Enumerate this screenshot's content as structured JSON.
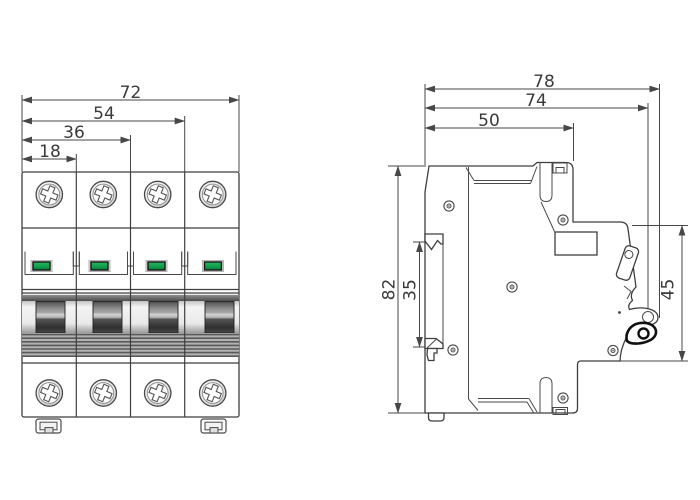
{
  "drawing": {
    "front_view": {
      "pole_count": 4,
      "dimensions": {
        "overall_width": "72",
        "width_three_modules": "54",
        "width_two_modules": "36",
        "module_width": "18"
      }
    },
    "side_view": {
      "dimensions": {
        "overall_depth": "78",
        "depth_to_toggle": "74",
        "body_depth": "50",
        "overall_height": "82",
        "din_slot_height": "35",
        "front_section_height": "45"
      }
    },
    "colors": {
      "line": "#3f3f3f",
      "dimension_line": "#474747",
      "indicator_green": "#0f9f4c",
      "handle_dark": "#3c3c3c",
      "background": "#ffffff"
    }
  }
}
